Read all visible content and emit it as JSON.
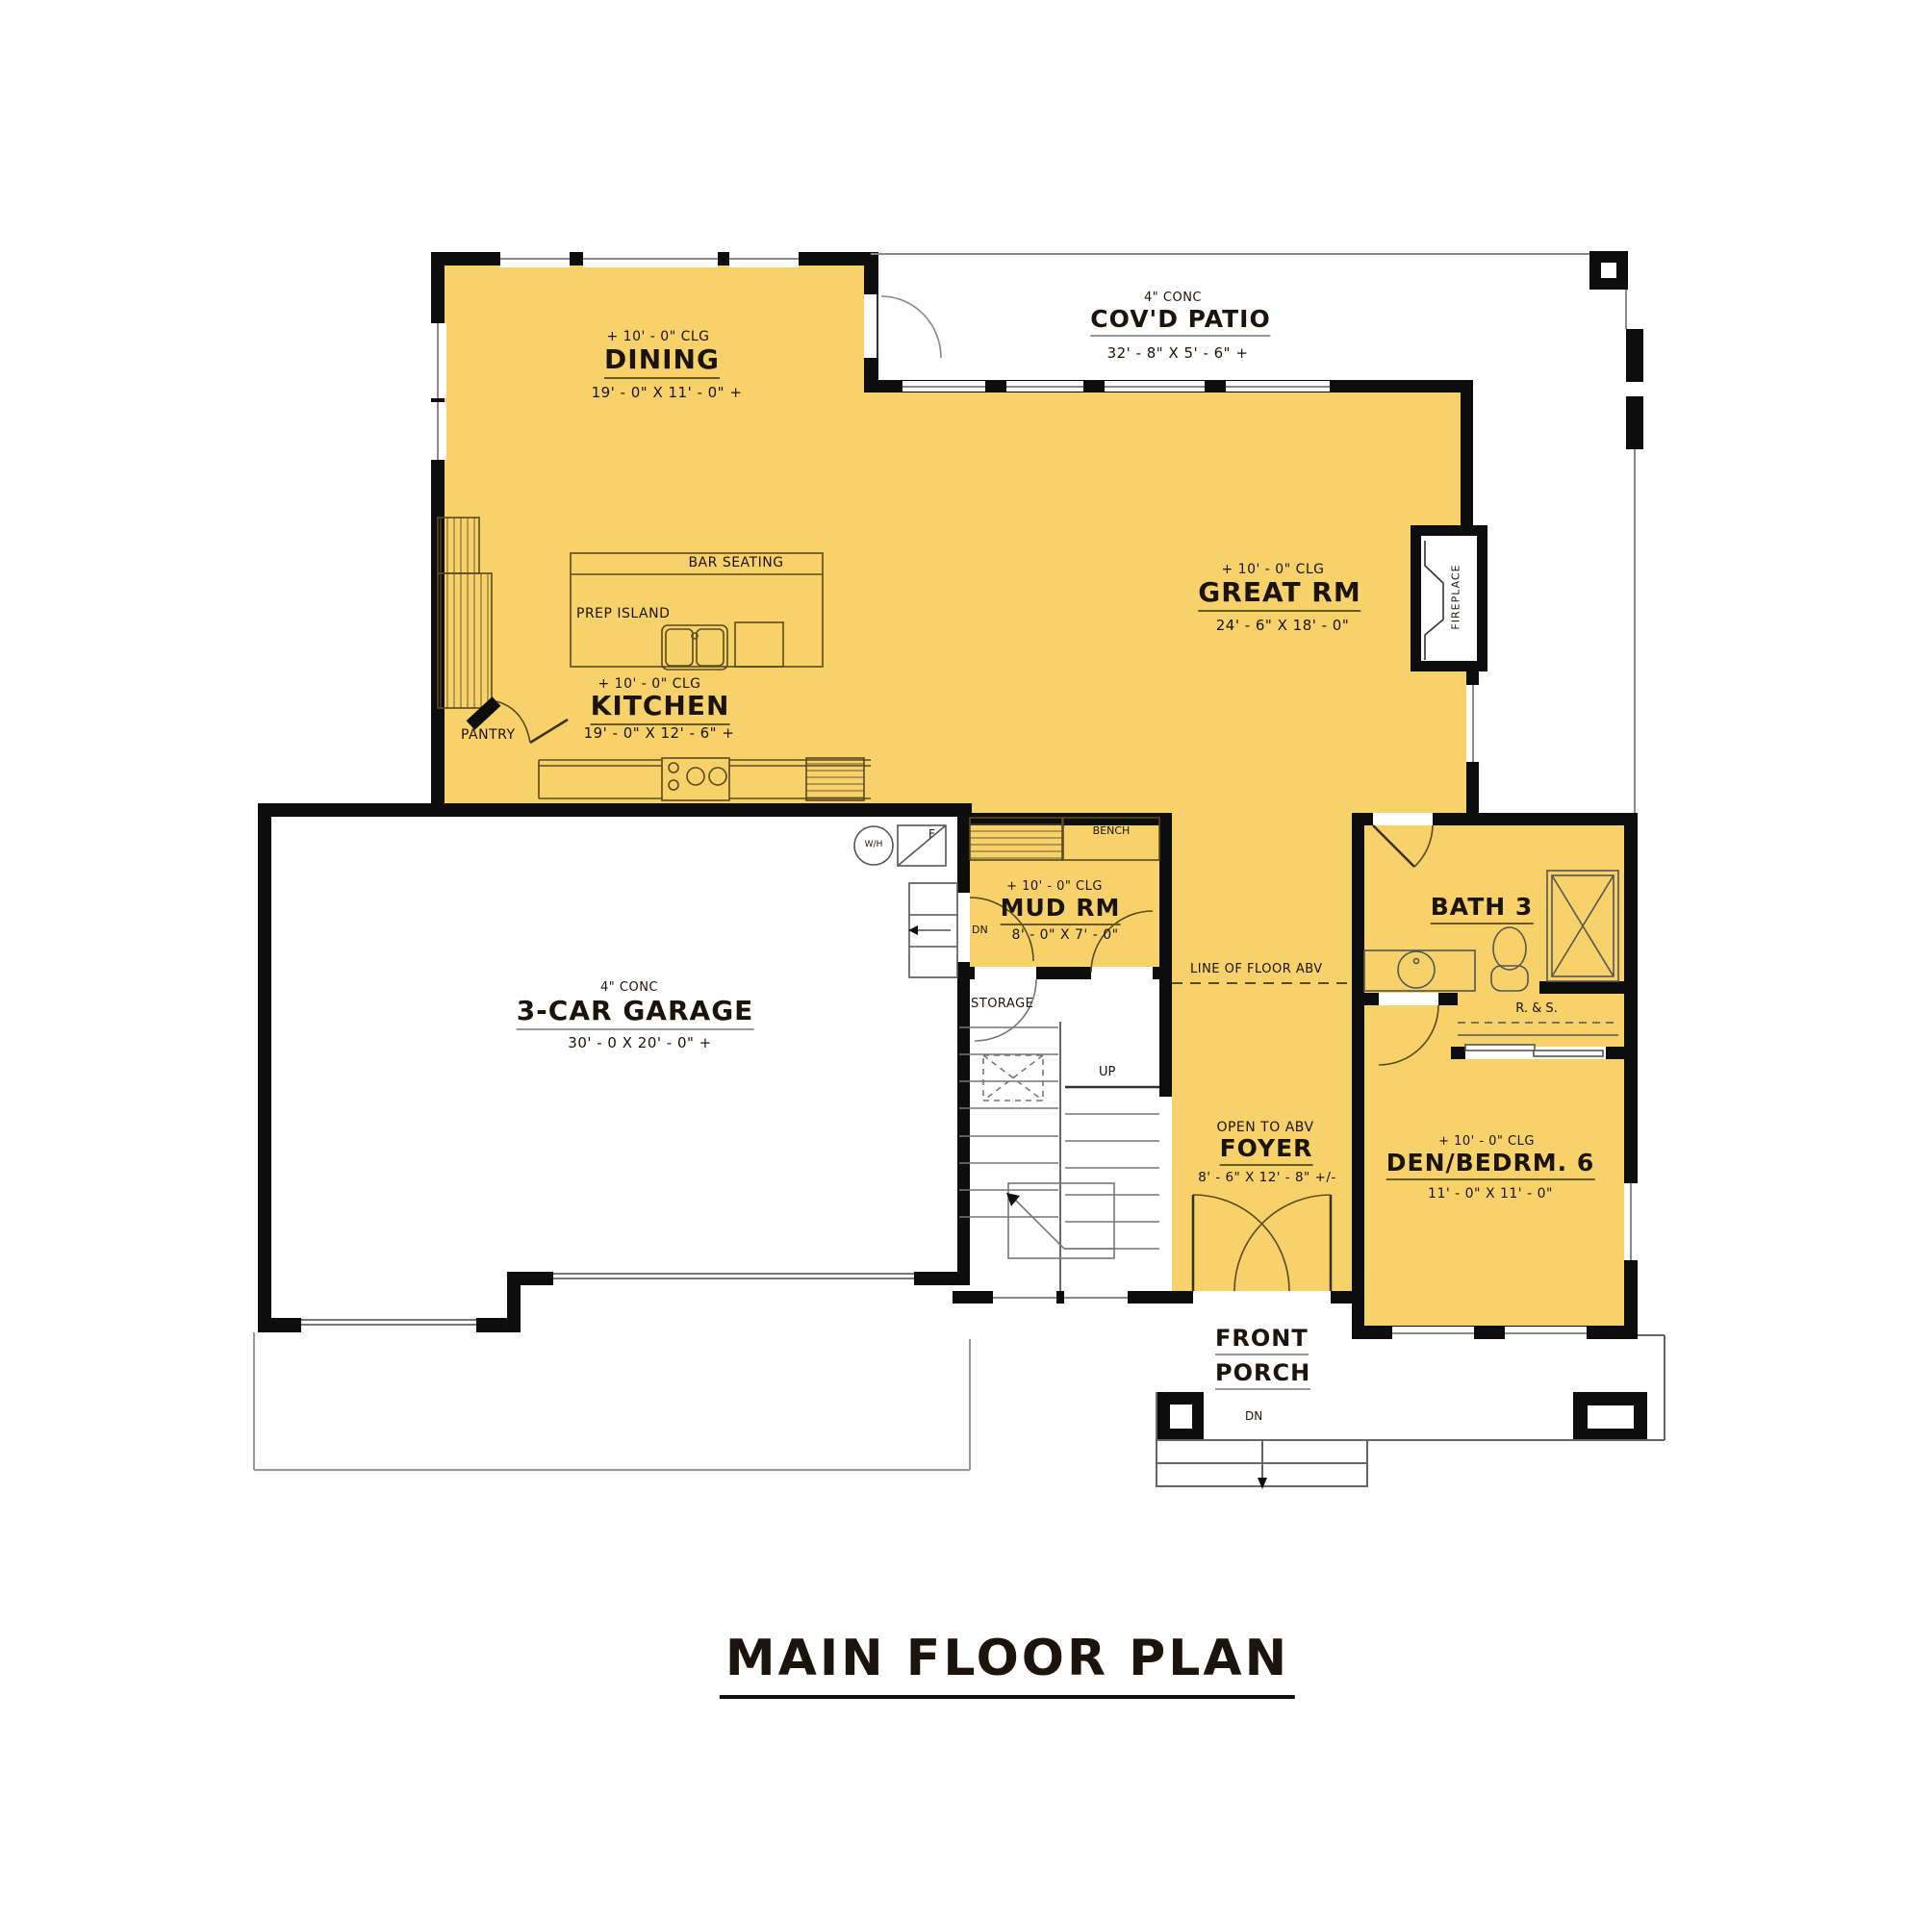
{
  "title": "MAIN FLOOR PLAN",
  "colors": {
    "room_fill": "#F7D169",
    "wall": "#0D0D0D",
    "thin_line": "#8A8A8A",
    "text": "#1B140C"
  },
  "rooms": {
    "dining": {
      "ceiling": "+ 10' - 0\" CLG",
      "name": "DINING",
      "dims": "19' - 0\" X 11' - 0\" +"
    },
    "covd_patio": {
      "slab": "4\" CONC",
      "name": "COV'D PATIO",
      "dims": "32' - 8\" X 5' - 6\" +"
    },
    "great_rm": {
      "ceiling": "+ 10' - 0\" CLG",
      "name": "GREAT RM",
      "dims": "24' - 6\" X 18' - 0\""
    },
    "kitchen": {
      "ceiling": "+ 10' - 0\" CLG",
      "name": "KITCHEN",
      "dims": "19' - 0\" X 12' - 6\" +"
    },
    "garage": {
      "slab": "4\" CONC",
      "name": "3-CAR GARAGE",
      "dims": "30' - 0 X 20' - 0\" +"
    },
    "mud_rm": {
      "ceiling": "+ 10' - 0\" CLG",
      "name": "MUD RM",
      "dims": "8' - 0\" X 7' - 0\""
    },
    "bath3": {
      "name": "BATH 3"
    },
    "foyer": {
      "note": "OPEN TO ABV",
      "name": "FOYER",
      "dims": "8' - 6\" X 12' - 8\" +/-"
    },
    "den_bedrm6": {
      "ceiling": "+ 10' - 0\" CLG",
      "name": "DEN/BEDRM. 6",
      "dims": "11' - 0\" X 11' - 0\""
    },
    "front_porch": {
      "name_line1": "FRONT",
      "name_line2": "PORCH"
    },
    "pantry": {
      "name": "PANTRY"
    },
    "storage": {
      "name": "STORAGE"
    }
  },
  "labels": {
    "bar_seating": "BAR SEATING",
    "prep_island": "PREP ISLAND",
    "bench": "BENCH",
    "fireplace": "FIREPLACE",
    "water_heater": "W/H",
    "furnace": "F",
    "rod_and_shelf": "R. & S.",
    "line_of_floor_abv": "LINE OF FLOOR ABV",
    "up": "UP",
    "dn_stairs": "DN",
    "dn_porch": "DN"
  }
}
